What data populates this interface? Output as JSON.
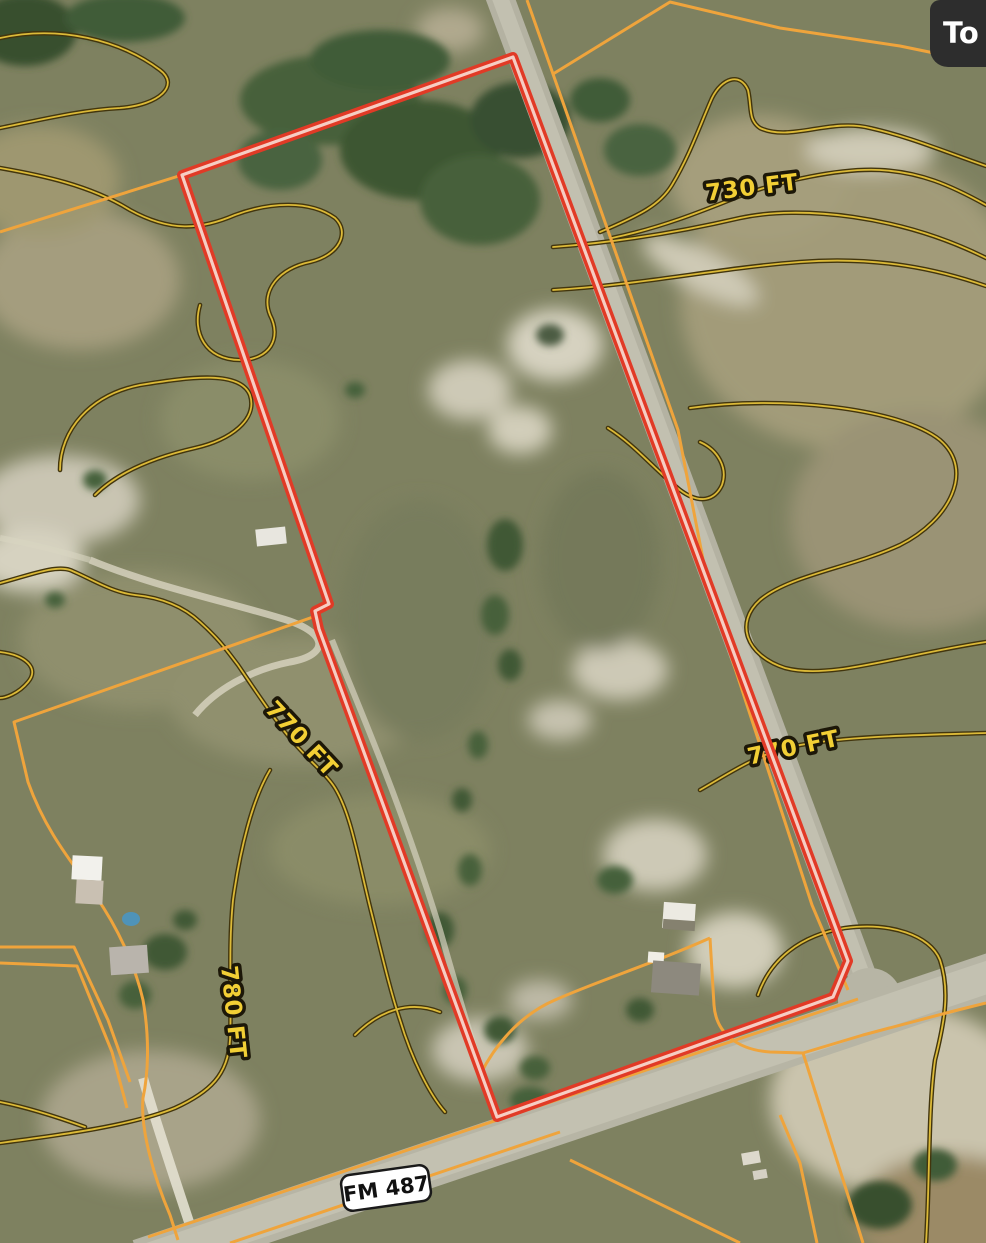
{
  "topo_button": {
    "label": "To"
  },
  "road_shield": {
    "label": "FM 487"
  },
  "contour_labels": [
    {
      "text": "730 FT",
      "elevation_ft": 730
    },
    {
      "text": "770 FT",
      "elevation_ft": 770
    },
    {
      "text": "770 FT",
      "elevation_ft": 770
    },
    {
      "text": "780 FT",
      "elevation_ft": 780
    }
  ],
  "colors": {
    "property_boundary_red": "#e13a26",
    "property_boundary_core": "#f6cdc3",
    "parcel_line_orange": "#efa43c",
    "contour_line_yellow": "#dcba38",
    "contour_casing": "#42350d",
    "contour_label_fill": "#f2cf35",
    "road_gray": "#b7b5a5",
    "shield_background": "#ffffff",
    "topo_button_background": "#2d2d2d"
  },
  "map_type": "satellite"
}
